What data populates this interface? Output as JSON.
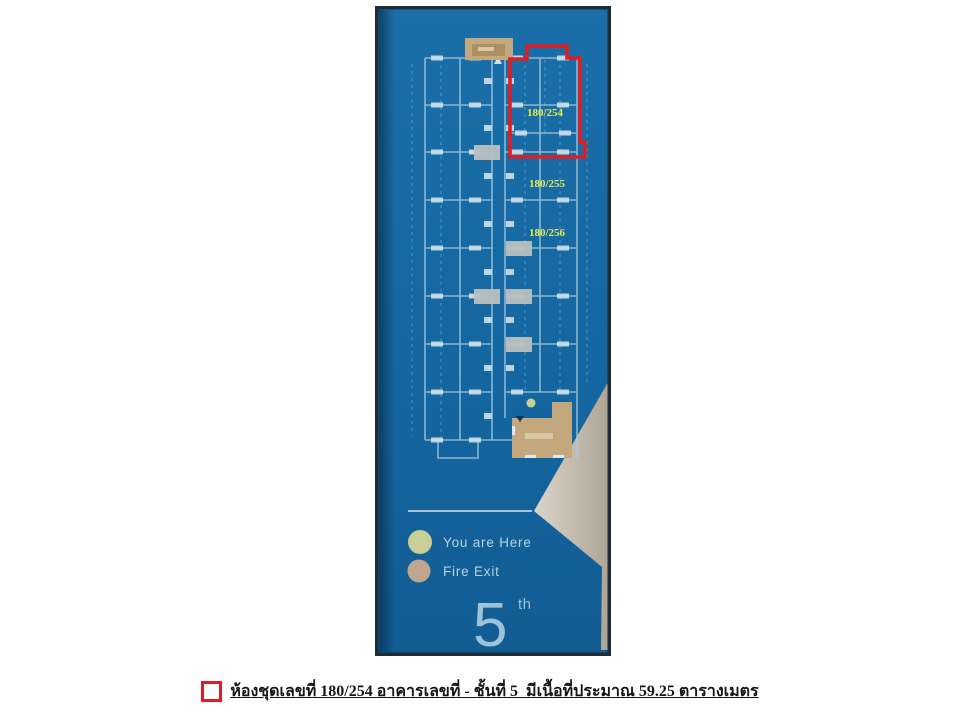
{
  "floor_sign": {
    "floor_number": "5",
    "floor_suffix": "th",
    "highlighted_unit": "180/254",
    "unit_labels": [
      "180/254",
      "180/255",
      "180/256"
    ],
    "legend": {
      "you_are_here_label": "You are Here",
      "fire_exit_label": "Fire Exit"
    },
    "colors": {
      "sign_blue": "#1668A2",
      "plan_lines": "#A9C9DB",
      "highlight_red": "#E01D23",
      "unit_label_yellow": "#E3EC4E",
      "fire_exit_tan": "#C3A87E",
      "you_are_here_green": "#C9CF96",
      "fire_exit_dot_tan": "#BFA78D",
      "wall_behind_gray": "#CDC5B8"
    }
  },
  "caption": {
    "text": "ห้องชุดเลขที่ 180/254 อาคารเลขที่ - ชั้นที่ 5  มีเนื้อที่ประมาณ 59.25 ตารางเมตร"
  }
}
